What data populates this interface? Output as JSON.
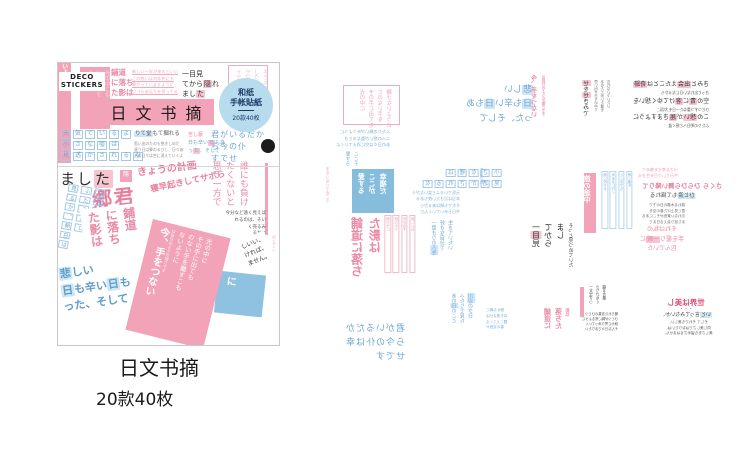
{
  "colors": {
    "pink": "#f2a3b7",
    "pink_text": "#e98ba6",
    "pink_light": "#f3bdcb",
    "pink_hl": "#f7c4d1",
    "blue_text": "#6fa7d2",
    "blue_hl": "#cfe6f6",
    "blue_bg": "#86bcdc",
    "badge_bg": "#b7dcee",
    "badge_text": "#1d3a66",
    "border": "#c9c9c9"
  },
  "package": {
    "brand_line1": "DECO",
    "brand_line2": "STICKERS",
    "title": "日文书摘",
    "badge": {
      "line1": "和纸",
      "line2": "手帐貼紙",
      "count": "20款40枚"
    },
    "items": [
      {
        "n": "left-edge-strip",
        "x": 0,
        "y": 0,
        "w": 13,
        "h": 100,
        "bg": "#f2a3b7",
        "fs": 6,
        "c": "#ffffff",
        "b": 1,
        "cols": [
          "今、手をつな",
          "いように"
        ]
      },
      {
        "n": "header-pink-sticker",
        "x": 22,
        "y": 4,
        "w": 30,
        "h": 62,
        "bg": "#f2a3b7",
        "pad": 3,
        "fs": 5.5,
        "c": "#fbd7e0",
        "cols": [
          "光の中にも",
          "いを選すて",
          "ように"
        ]
      },
      {
        "n": "hodou-header-lines",
        "x": 53,
        "y": 5,
        "fs": 7.5,
        "c": "#e98ba6",
        "b": 1,
        "lh": 1.3,
        "lines": [
          "鋪道",
          "に落ち",
          "た影は"
        ]
      },
      {
        "n": "underlined-pink-lines",
        "x": 74,
        "y": 6,
        "fs": 4.2,
        "c": "#f0aabd",
        "u": 1,
        "lh": 1.6,
        "lines": [
          "新しい一年が来るといい",
          "この想いは何年先にも",
          "繋がっていますように",
          "いつもあなたを思ってる"
        ]
      },
      {
        "n": "hitomi-header-lines",
        "x": 124,
        "y": 6,
        "fs": 7,
        "c": "#2f2f2f",
        "hl": "#f7c4d1",
        "lh": 1.45,
        "lines": [
          "一目見",
          "てから[隠]れ",
          "まし[た]"
        ]
      },
      {
        "n": "header-pink-box",
        "x": 170,
        "y": 2,
        "w": 40,
        "h": 53,
        "bd": "#efacbf",
        "pad": 3,
        "fs": 5.5,
        "c": "#f3bdcb",
        "cols": [
          "キラキラ",
          "した日々",
          "ヲ忘レナ",
          "イデ"
        ]
      },
      {
        "n": "boxed-blue-rows",
        "x": 2,
        "y": 66,
        "fs": 6,
        "c": "#6fa7d2",
        "boxed": 1,
        "bc": "#a3c9e6",
        "lh": 1.7,
        "lines": [
          "元気でいるよ",
          "小さな嘘は",
          "見透かされるな"
        ]
      },
      {
        "n": "hitori-block-heading",
        "x": 76,
        "y": 68,
        "fs": 5.5,
        "c": "#5b5b5b",
        "hl": "#cfe6f6",
        "lines": [
          "[りて堂]もて摑れる"
        ]
      },
      {
        "n": "hitori-block-lines",
        "x": 76,
        "y": 78,
        "fs": 3.8,
        "c": "#8b8b8b",
        "lh": 1.6,
        "lines": [
          "思い出のたのも抱きしめた",
          "違う日は夢のるびし、日々あ",
          "あの日々は空に消えていくよ"
        ]
      },
      {
        "n": "kanashii-mini-1",
        "x": 130,
        "y": 69,
        "fs": 5,
        "c": "#e98ba6",
        "lines": [
          "苦し厭"
        ]
      },
      {
        "n": "kanashii-mini-2",
        "x": 130,
        "y": 77,
        "fs": 5,
        "c": "#6fa7d2",
        "hl": "#f7c4d1",
        "lh": 1.5,
        "lines": [
          "日も辛い[日]もあ",
          "っ[た]、そして"
        ]
      },
      {
        "n": "kimiga-block",
        "x": 153,
        "y": 66,
        "fs": 8,
        "c": "#6fa7d2",
        "ls": 1,
        "lh": 1.5,
        "lines": [
          "君がいるだか",
          "ら今の仆",
          "すでせ"
        ]
      },
      {
        "n": "black-circle-badge",
        "x": 203,
        "y": 76,
        "w": 14,
        "h": 14,
        "bg": "#1c1c1c",
        "r": 1,
        "fs": 3,
        "c": "#ffffff",
        "ta": "center",
        "lines": [
          ""
        ]
      },
      {
        "n": "kimiga-tiny-lines",
        "x": 196,
        "y": 95,
        "fs": 3,
        "c": "#9cc4e2",
        "lh": 1.4,
        "lines": [
          "·········",
          "·········"
        ]
      },
      {
        "n": "mashita-large",
        "x": 2,
        "y": 106,
        "fs": 15,
        "c": "#2f2f2f",
        "hl": "#f7c4d1",
        "ls": 2,
        "lines": [
          "まし[た]"
        ]
      },
      {
        "n": "small-pink-char-box",
        "x": 62,
        "y": 107,
        "w": 12,
        "h": 12,
        "bg": "#f2a3b7",
        "fs": 6,
        "c": "#ffffff",
        "ta": "center",
        "pad": 1,
        "lines": [
          "隠"
        ]
      },
      {
        "n": "kyou-no-keikaku",
        "x": 79,
        "y": 100,
        "rot": -7,
        "fs": 10,
        "c": "#e87f9d",
        "b": 1,
        "lines": [
          "きょうの計画"
        ]
      },
      {
        "n": "gou-kun",
        "x": 34,
        "y": 122,
        "rot": -6,
        "fs": 20,
        "c": "#e87f9d",
        "b": 1,
        "ls": 2,
        "lines": [
          "郷君"
        ]
      },
      {
        "n": "hayaoki",
        "x": 92,
        "y": 114,
        "rot": -12,
        "fs": 8.5,
        "c": "#e87f9d",
        "b": 1,
        "lines": [
          "寝早起きしてサボら"
        ]
      },
      {
        "n": "left-blue-strips",
        "x": 0,
        "y": 122,
        "h": 90,
        "rot": 10,
        "fs": 5.5,
        "c": "#6fa7d2",
        "boxed": 1,
        "bc": "#a3c9e6",
        "cols": [
          "今日もか",
          "ふたこ奉ロ",
          "見るか、朝日は"
        ]
      },
      {
        "n": "hodou-large",
        "x": 26,
        "y": 143,
        "h": 72,
        "rot": -7,
        "bg": "#ffffff",
        "pad": 3,
        "fs": 12,
        "c": "#e98ba6",
        "b": 1,
        "cols": [
          "鋪道",
          "に落ち",
          "た影は"
        ]
      },
      {
        "n": "kanashii-large",
        "x": 0,
        "y": 196,
        "rot": -8,
        "bg": "#ffffff",
        "pad": 3,
        "fs": 11,
        "c": "#5f9dcb",
        "b": 1,
        "hl": "#cfe6f6",
        "lh": 1.5,
        "lines": [
          "[悲]しい",
          "[日]も辛い[日]も",
          "った、そして"
        ]
      },
      {
        "n": "darenimo-vcols",
        "x": 150,
        "y": 98,
        "h": 75,
        "fs": 9,
        "c": "#e98ba6",
        "cols": [
          "誰にも負け",
          "たくないと",
          "思う一方で"
        ]
      },
      {
        "n": "pink-side-bar",
        "x": 207,
        "y": 100,
        "w": 3,
        "h": 72,
        "bg": "#f2a3b7",
        "lines": [
          ""
        ]
      },
      {
        "n": "small-black-lines",
        "x": 138,
        "y": 148,
        "w": 70,
        "ta": "right",
        "fs": 4.5,
        "c": "#555555",
        "lh": 1.5,
        "lines": [
          "今分など遠く見えば",
          "れるのは、そい",
          "く売るみ",
          "るかに",
          "の先を"
        ]
      },
      {
        "n": "right-edge-pink-col",
        "x": 212,
        "y": 172,
        "h": 40,
        "fs": 4,
        "c": "#f0aabd",
        "cols": [
          "怒りのが",
          "がく了こ"
        ]
      },
      {
        "n": "blue-corner-sticker",
        "x": 158,
        "y": 210,
        "w": 48,
        "h": 42,
        "rot": 6,
        "bg": "#8ec2e0",
        "pad": 4,
        "fs": 10,
        "c": "#ffffff",
        "b": 1,
        "cols": [
          "に"
        ]
      },
      {
        "n": "shii-sticker",
        "x": 183,
        "y": 172,
        "rot": -22,
        "bg": "#ffffff",
        "pad": 3,
        "fs": 6,
        "c": "#3a3a3a",
        "lh": 1.5,
        "lines": [
          "しいい、",
          "ければ、",
          "ません。"
        ]
      },
      {
        "n": "pink-big-sticker",
        "x": 80,
        "y": 164,
        "w": 80,
        "h": 114,
        "rot": 14,
        "bg": "#f2a3b7",
        "pad": 5,
        "fs": 6.5,
        "c": "#ffffff",
        "lh": 1.2,
        "cols": [
          "光の中に",
          "その手に出ても",
          "のない手を離すこも",
          "ないように",
          "~は自分のような強さです",
          "*今、手をつない"
        ]
      }
    ]
  },
  "caption": {
    "title": "日文书摘",
    "subtitle": "20款40枚"
  },
  "sheet": {
    "items": [
      {
        "n": "sheet-pink-box",
        "x": 23,
        "y": 30,
        "w": 57,
        "h": 40,
        "bd": "#efacbf",
        "pad": 3,
        "m": 1,
        "fs": 5.5,
        "c": "#f0aabd",
        "cols": [
          "光の中に",
          "その手に出ても",
          "とのない手を",
          "離さないように"
        ]
      },
      {
        "n": "sheet-blue-small-lines-1",
        "x": 16,
        "y": 74,
        "m": 1,
        "fs": 4.2,
        "c": "#7fb0d6",
        "lh": 1.6,
        "lines": [
          "ふたりの願いが叶うように",
          "二人の想いが重なるとき",
          "あの日々は空に消えていくよ"
        ]
      },
      {
        "n": "sheet-kanashii-block",
        "x": 105,
        "y": 28,
        "w": 108,
        "m": 1,
        "fs": 9,
        "c": "#6fa7d2",
        "hl": "#cfe6f6",
        "lh": 1.6,
        "lines": [
          "[悲]しい",
          "[日]も辛い[日]もあ",
          "った、そして"
        ]
      },
      {
        "n": "sheet-tewotsunai-mini",
        "x": 210,
        "y": 20,
        "h": 58,
        "m": 1,
        "fs": 6,
        "c": "#e98ba6",
        "b": 1,
        "cols": [
          "今、手をつない",
          "~は自分のような強さです"
        ]
      },
      {
        "n": "sheet-hitoride-col",
        "x": 262,
        "y": 25,
        "h": 52,
        "m": 1,
        "fs": 6,
        "c": "#3a3a3a",
        "hl": "#f7c4d1",
        "cols": [
          "[せ]を[せ]きみで"
        ]
      },
      {
        "n": "sheet-tiny-cols-1",
        "x": 272,
        "y": 25,
        "h": 50,
        "m": 1,
        "fs": 3.5,
        "c": "#6b6b6b",
        "cols": [
          "思い出す日々の中で",
          "あなたと歩いた道を",
          "忘れないでいたい"
        ]
      },
      {
        "n": "sheet-rows-trio",
        "x": 313,
        "y": 25,
        "m": 1,
        "fs": 6,
        "c": "#2f2f2f",
        "hl": "#f7c4d1",
        "lh": 1.7,
        "lines": [
          "きみと[出会]えたことは[奇跡]",
          "~きっと忘れない日になるから",
          "空の[青]に[溶]けてゆく想いを",
          "~ひとつずつ重ねた一日を大切に",
          "この[想い]が[届]きますように",
          "~ふたりの明日へと続く道"
        ]
      },
      {
        "n": "sheet-blue-cols-mid",
        "x": 24,
        "y": 96,
        "h": 26,
        "m": 1,
        "fs": 5,
        "c": "#7fb0d6",
        "cols": [
          "夏すろ",
          "ここチ"
        ]
      },
      {
        "n": "sheet-pink-thin-col",
        "x": 3,
        "y": 112,
        "h": 48,
        "m": 1,
        "fs": 4,
        "c": "#f0aabd",
        "cols": [
          "手をつないで歩こう"
        ]
      },
      {
        "n": "sheet-blue-square",
        "x": 32,
        "y": 114,
        "w": 42,
        "h": 44,
        "bg": "#86bcdc",
        "pad": 4,
        "m": 1,
        "fs": 7,
        "c": "#ffffff",
        "b": 1,
        "cols": [
          "愛する",
          "ここが",
          "幸福だ"
        ]
      },
      {
        "n": "sheet-boxed-rows",
        "x": 102,
        "y": 113,
        "m": 1,
        "fs": 5.5,
        "c": "#6fa7d2",
        "boxed": 1,
        "bc": "#a3c9e6",
        "lh": 1.8,
        "lines": [
          "小さな嘘は",
          "見透かされるな"
        ]
      },
      {
        "n": "sheet-blue-small-lines-2",
        "x": 92,
        "y": 135,
        "m": 1,
        "fs": 4,
        "c": "#7fb0d6",
        "lh": 1.6,
        "lines": [
          "元気でいるよと笑いながら",
          "本当は泣きたい夜もある",
          "それでも朝は来るから",
          "今日も歩いていくんだ"
        ]
      },
      {
        "n": "sheet-seikatsu-col",
        "x": 157,
        "y": 113,
        "h": 40,
        "m": 1,
        "fs": 4,
        "c": "#7fb0d6",
        "cols": [
          "生活され"
        ]
      },
      {
        "n": "sheet-hodou-bold",
        "x": 28,
        "y": 162,
        "h": 50,
        "m": 1,
        "fs": 12,
        "c": "#e98ba6",
        "b": 1,
        "cols": [
          "鋪道に落ち",
          "た影は"
        ]
      },
      {
        "n": "sheet-strip-cols-1",
        "x": 63,
        "y": 160,
        "h": 58,
        "m": 1,
        "fs": 3.5,
        "c": "#e8a0b5",
        "colbd": "#f0bcca",
        "cols": [
          "朝の光に",
          "誘われて",
          "歩き出す",
          "新しい日"
        ]
      },
      {
        "n": "sheet-jinsei-cols",
        "x": 110,
        "y": 165,
        "h": 60,
        "m": 1,
        "fs": 5,
        "c": "#6fa7d2",
        "hl": "#cfe6f6",
        "cols": [
          "一度きりの[人生]",
          "好きな自分で",
          "生きていたい"
        ]
      },
      {
        "n": "sheet-tabi-bar",
        "x": 264,
        "y": 118,
        "w": 12,
        "h": 60,
        "bg": "#f2a3b7",
        "pad": 2,
        "m": 1,
        "fs": 7,
        "c": "#ffffff",
        "b": 1,
        "cols": [
          "旅の途中"
        ]
      },
      {
        "n": "sheet-strip-cols-2",
        "x": 280,
        "y": 116,
        "h": 58,
        "m": 1,
        "fs": 3.5,
        "c": "#7fb0d6",
        "colbd": "#b9d7ec",
        "cols": [
          "風に吹かれ",
          "気ままに行く",
          "どこまでも",
          "続く道を"
        ]
      },
      {
        "n": "sheet-pink-small-lines",
        "x": 318,
        "y": 112,
        "m": 1,
        "fs": 4,
        "c": "#ee9db4",
        "lh": 1.5,
        "lines": [
          "小さな幸せを集めて",
          "今日という日を生きる"
        ]
      },
      {
        "n": "sheet-sakura-lines",
        "x": 322,
        "y": 127,
        "m": 1,
        "fs": 6.5,
        "c": "#e87f9d",
        "b": 1,
        "lines": [
          "さくら ひらひら舞い降りて"
        ]
      },
      {
        "n": "sheet-hitonami-line",
        "x": 330,
        "y": 138,
        "m": 1,
        "fs": 5.5,
        "c": "#4a4a4a",
        "hl": "#cfe6f6",
        "lines": [
          "[ひと涙]もて揺れる"
        ]
      },
      {
        "n": "sheet-sakura-small",
        "x": 322,
        "y": 148,
        "m": 1,
        "fs": 3.6,
        "c": "#6b6b6b",
        "lh": 1.55,
        "lines": [
          "揺れる木漏れ日の下で",
          "君と見上げた春の空を",
          "忘れない景色がそこにある",
          "また巡り会える日まで"
        ]
      },
      {
        "n": "sheet-hitomi-vblock",
        "x": 210,
        "y": 168,
        "h": 76,
        "m": 1,
        "fs": 8,
        "c": "#2f2f2f",
        "hl": "#f7c4d1",
        "cols": [
          "一[目]見",
          "てから",
          "まし",
          "~そっと見つめていた"
        ]
      },
      {
        "n": "sheet-isshun-lines",
        "x": 298,
        "y": 170,
        "w": 88,
        "ta": "center",
        "m": 1,
        "fs": 6,
        "c": "#e98ba6",
        "hl": "#f7c4d1",
        "lh": 1.6,
        "lines": [
          "それは私の",
          "手を握り[一瞬]に",
          "包んでいた"
        ]
      },
      {
        "n": "sheet-kimiga-block",
        "x": 25,
        "y": 268,
        "m": 1,
        "fs": 9,
        "c": "#6fa7d2",
        "ls": 1,
        "lh": 1.55,
        "lines": [
          "君がいるだか",
          "ら今の仆は幸",
          "せです"
        ]
      },
      {
        "n": "sheet-kawabe-cols",
        "x": 130,
        "y": 238,
        "h": 62,
        "m": 1,
        "fs": 5,
        "c": "#6fa7d2",
        "hl": "#cfe6f6",
        "cols": [
          "あの[日]のこと",
          "ふたりで見た",
          "[川辺]の夕日"
        ]
      },
      {
        "n": "sheet-blue-small-lines-3",
        "x": 166,
        "y": 253,
        "w": 42,
        "ta": "right",
        "m": 1,
        "fs": 3.6,
        "c": "#7fb0d6",
        "lh": 1.6,
        "lines": [
          "静かな朝に",
          "耳を澄ませば",
          "聞こえてくる",
          "春の足音が"
        ]
      },
      {
        "n": "sheet-hodou-small",
        "x": 222,
        "y": 253,
        "h": 42,
        "m": 1,
        "fs": 7,
        "c": "#e98ba6",
        "b": 1,
        "cols": [
          "鋪道に",
          "落ちた",
          "~影は"
        ]
      },
      {
        "n": "sheet-pink-bar-2",
        "x": 260,
        "y": 232,
        "w": 4,
        "h": 30,
        "bg": "#f2a3b7",
        "m": 1,
        "lines": [
          ""
        ]
      },
      {
        "n": "sheet-black-cols",
        "x": 266,
        "y": 230,
        "h": 34,
        "m": 1,
        "fs": 3.8,
        "c": "#4a4a4a",
        "cols": [
          "一文字ずつ",
          "さりげなく",
          "綴る言葉"
        ]
      },
      {
        "n": "sheet-black-list",
        "x": 262,
        "y": 257,
        "m": 1,
        "fs": 3.3,
        "c": "#555555",
        "lh": 1.55,
        "lines": [
          "綴られた言葉のひとつ",
          "ひとつが胸に残るように",
          "静かに寄り添っていく",
          "そんな日々でありたい"
        ]
      },
      {
        "n": "sheet-sekai-heading",
        "x": 336,
        "y": 243,
        "w": 60,
        "ta": "center",
        "m": 1,
        "fs": 7.5,
        "c": "#d94f72",
        "b": 1,
        "lh": 1.2,
        "lines": [
          "世界は美し",
          "~・・・"
        ]
      },
      {
        "n": "sheet-sekai-line",
        "x": 336,
        "y": 257,
        "w": 60,
        "ta": "center",
        "m": 1,
        "fs": 5,
        "c": "#3a3a3a",
        "hl": "#cfe6f6",
        "lines": [
          "[いと]言ってみないか、"
        ]
      },
      {
        "n": "sheet-sekai-small",
        "x": 325,
        "y": 265,
        "w": 85,
        "ta": "center",
        "m": 1,
        "fs": 3.6,
        "c": "#555555",
        "lh": 1.55,
        "lines": [
          "そして それでも美しい、",
          "同じ美しさではなりたいは、",
          "美しさをも留めざるはません、"
        ]
      }
    ]
  }
}
